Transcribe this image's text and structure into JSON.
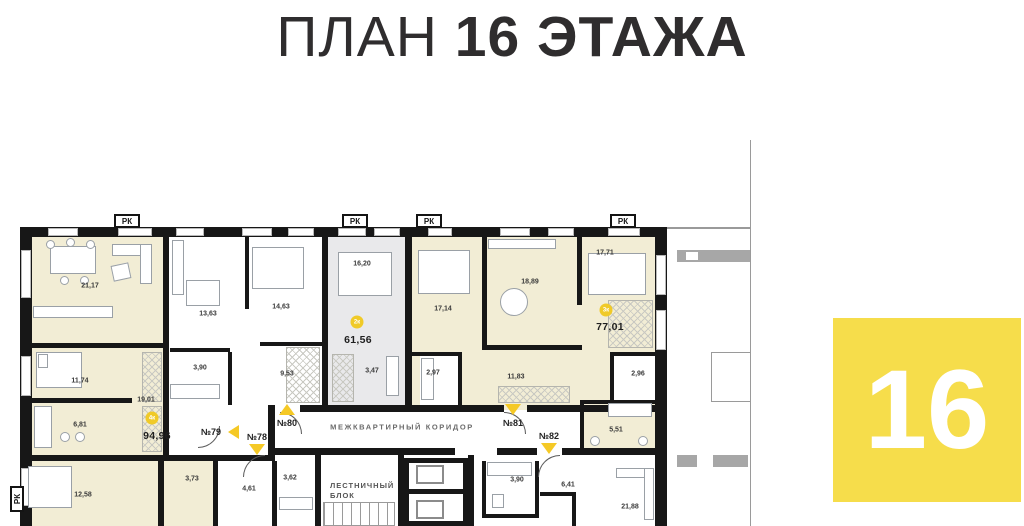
{
  "title": {
    "prefix": "ПЛАН",
    "emphasis": "16 ЭТАЖА"
  },
  "floor_badge": "16",
  "marker_rk": "РК",
  "corridor_label": "МЕЖКВАРТИРНЫЙ КОРИДОР",
  "stairwell": {
    "line1": "ЛЕСТНИЧНЫЙ",
    "line2": "БЛОК"
  },
  "apartments": {
    "a78": "№78",
    "a79": "№79",
    "a80": "№80",
    "a81": "№81",
    "a82": "№82"
  },
  "totals": {
    "t61": "61,56",
    "t77": "77,01",
    "t94": "94,96"
  },
  "badges": {
    "b61": "2к",
    "b77": "3к",
    "b94": "4к"
  },
  "rooms": {
    "r21_17": "21,17",
    "r13_63": "13,63",
    "r14_63": "14,63",
    "r16_20": "16,20",
    "r17_14": "17,14",
    "r18_89": "18,89",
    "r17_71": "17,71",
    "r11_74": "11,74",
    "r19_01": "19,01",
    "r3_90c": "3,90",
    "r9_53": "9,53",
    "r3_47": "3,47",
    "r2_97": "2,97",
    "r11_83": "11,83",
    "r2_96": "2,96",
    "r6_81": "6,81",
    "r5_51": "5,51",
    "r12_58": "12,58",
    "r3_73": "3,73",
    "r4_61": "4,61",
    "r3_62": "3,62",
    "r3_90r": "3,90",
    "r6_41": "6,41",
    "r21_88": "21,88"
  },
  "colors": {
    "accent_yellow": "#f6dd4b",
    "door_yellow": "#f5c926",
    "wall": "#171717",
    "room_cream": "#f2edd5",
    "room_gray": "#e9e9eb",
    "neighbor_gray": "#a7a7a7",
    "title": "#2f2d2e"
  }
}
